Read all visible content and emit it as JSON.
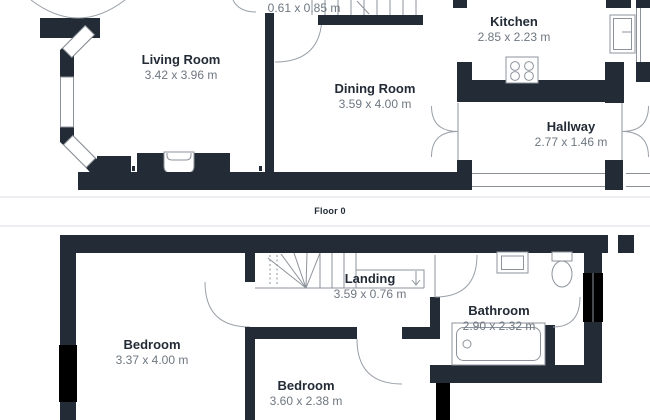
{
  "palette": {
    "wall": "#222B36",
    "outline": "#8D939B",
    "arc": "#9AA1A9",
    "room_name": "#222B36",
    "dimension": "#6E7780",
    "divider": "#ECEEF1",
    "background": "#FFFFFF"
  },
  "floor0": {
    "caption": "Floor 0",
    "living_room": {
      "name": "Living Room",
      "dims": "3.42 x 3.96 m"
    },
    "dining_room": {
      "name": "Dining Room",
      "dims": "3.59 x 4.00 m"
    },
    "kitchen": {
      "name": "Kitchen",
      "dims": "2.85 x 2.23 m"
    },
    "hallway": {
      "name": "Hallway",
      "dims": "2.77 x 1.46 m"
    },
    "under_stairs": {
      "dims": "0.61 x 0.85 m"
    }
  },
  "floor1": {
    "bedroom_front": {
      "name": "Bedroom",
      "dims": "3.37 x 4.00 m"
    },
    "bedroom_back": {
      "name": "Bedroom",
      "dims": "3.60 x 2.38 m"
    },
    "landing": {
      "name": "Landing",
      "dims": "3.59 x 0.76 m"
    },
    "bathroom": {
      "name": "Bathroom",
      "dims": "2.90 x 2.32 m"
    }
  }
}
